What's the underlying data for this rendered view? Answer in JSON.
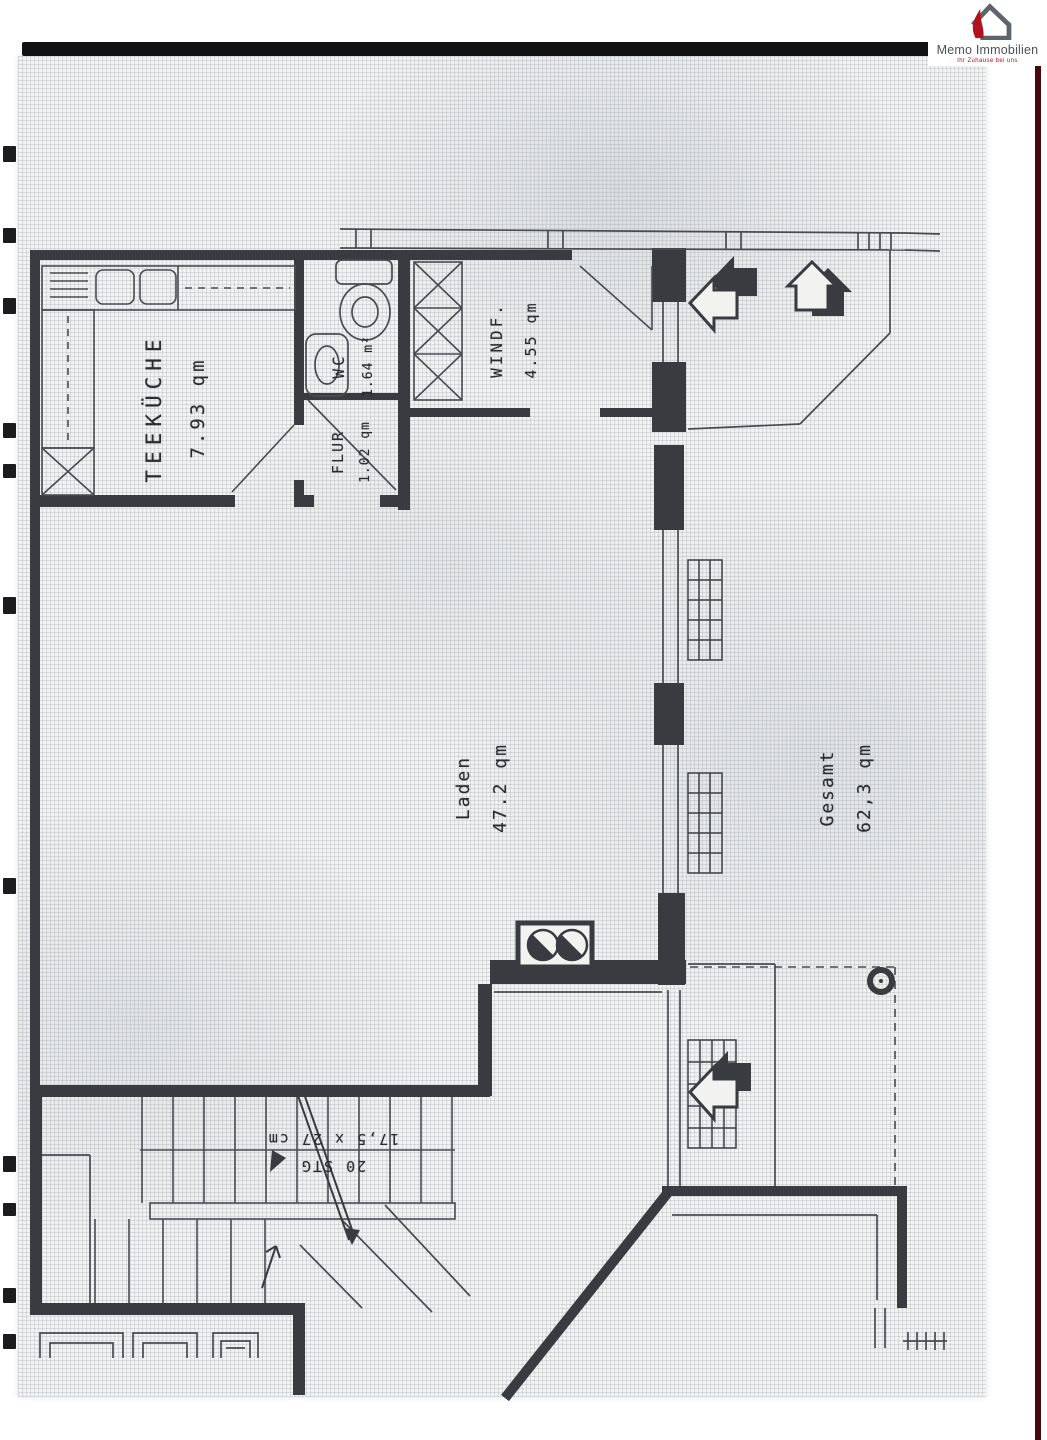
{
  "logo": {
    "name": "Memo Immobilien",
    "tagline": "Ihr Zuhause bei uns"
  },
  "plan": {
    "rooms": {
      "teekueche": {
        "name": "TEEKÜCHE",
        "area": "7.93 qm"
      },
      "wc": {
        "name": "WC",
        "area": "1.64 m²"
      },
      "flur": {
        "name": "FLUR",
        "area": "1.02 qm"
      },
      "windfang": {
        "name": "WINDF.",
        "area": "4.55 qm"
      },
      "laden": {
        "name": "Laden",
        "area": "47.2 qm"
      }
    },
    "total": {
      "label": "Gesamt",
      "area": "62,3 qm"
    },
    "stairs": {
      "count": "20 STG",
      "step_size": "17,5 x 27 cm"
    }
  },
  "colors": {
    "accent_red": "#b0121f",
    "ink": "#3a3b40",
    "paper": "#f2f2f0"
  }
}
